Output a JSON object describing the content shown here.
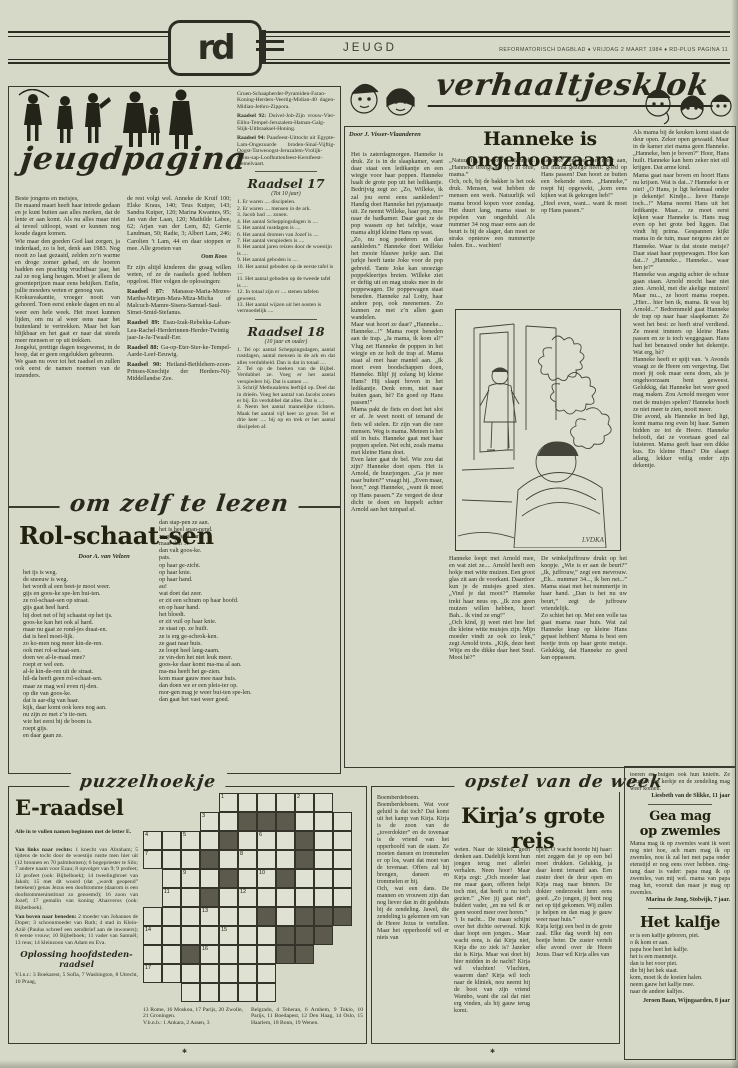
{
  "page": {
    "paper": "#d6d9c8",
    "ink": "#2e2d24"
  },
  "header": {
    "logo": "rd",
    "section": "JEUGD",
    "meta": "REFORMATORISCH DAGBLAD  ♦  VRIJDAG 2 MAART 1984  ♦  RD-PLUS PAGINA 11"
  },
  "jeugd": {
    "script_title": "jeugdpagina",
    "col1": [
      "Beste jongens en meisjes,",
      "De maand maart heeft haar intrede gedaan en je kunt buiten aan alles merken, dat de lente er aan komt. Als nu alles maar niet al teveel uitloopt, want er kunnen nog koude dagen komen.",
      "Wie maar den goeden God laat zorgen, ja inderdaad, zo is het, denk aan 1983. Nog nooit zo laat gezaaid, zelden zo’n warme en droge zomer gehad, en de boeren hadden een prachtig vruchtbaar jaar, het zal ze nog lang heugen. Moet je alleen de groenteprijzen maar eens bekijken. Enfin, jullie moeders weten er genoeg van.",
      "Krokusvakantie, vroeger nooit van gehoord. Toen eerst enkele dagen en nu al weer een hele week. Het moet kunnen lijden, om nu al weer eens naar het buitenland te vertrekken. Maar het kan blijkbaar en het gaat er naar dat steeds meer mensen er op uit trekken.",
      "Jongelui, prettige dagen toegewenst, in de hoop, dat er geen ongelukken gebeuren.",
      "We gaan nu over tot het raadsel en zullen ook eerst de namen noemen van de inzenders."
    ],
    "col2_intro": "de rest volgt wel. Anneke de Kruif 100; Elske Kraus, 140; Teus Kuiper, 143; Sandra Kuiper, 120; Marina Kwantes, 95; Jan van der Laan, 120; Mathilde Labee, 62; Arjan van der Lem, 82; Gerrie Landman, 50; Radie, 3; Albert Lam, 246; Carolien ’t Lam, 44 en daar stoppen er mee. Alle groeten van",
    "col2_sig": "Oom Koos",
    "col2_note": "Er zijn altijd kinderen die graag willen weten, of ze de raadsels goed hebben opgelost. Hier volgen de oplossingen:",
    "col2_answers": [
      {
        "lead": "Raadsel 87:",
        "text": "Manasse-Maria-Mozes-Martha-Mirjam-Mara-Miza-Micha of Malcuch-Mamre-Sisera-Samuel-Saul-Simei-Smid-Stefanus."
      },
      {
        "lead": "Raadsel 89:",
        "text": "Esau-Izak-Rebekka-Laban-Lea-Rachel-Herderinnen-Herder-Twintig jaar-Ja-Ja-Twaalf-Eer."
      },
      {
        "lead": "Raadsel 88:",
        "text": "Ga-op-Eter-Ster-ke-Tempel-Aarde-Leef-Eeuwig."
      },
      {
        "lead": "Raadsel 90:",
        "text": "Heiland-Bethlehem-zoon-Prinses-Knechtje der Herders-Nij-Middellandse Zee."
      }
    ],
    "col3_top": "Gruen-Schaapherder-Pyramiden-Farao-Koning-Herders-Veertig-Midian-40 dagen-Midian-Jethro-Zippora.",
    "col3_answers": [
      {
        "lead": "Raadsel 92:",
        "text": "Duivel-Job-Zijn vrouw-Vier-Elihu-Tempel-Jeruzalem-Haman-Galg-Slijk-Uitbraaksel-Honing."
      },
      {
        "lead": "Raadsel 94:",
        "text": "Paasfeest-Uittocht uit Egypte-Lam-Ongezuurde broden-Sinaï-Vijftig-Oogst-Tarweoogst-Jeruzalem-Vrolijk-Sions-sap-Loofhuttenfeest-Kerstfeest-Hemelvaart."
      }
    ],
    "raadsel17": {
      "title": "Raadsel 17",
      "subtitle": "(Tot 10 jaar)",
      "items": [
        "1. Er waren .... discipelen.",
        "2. Er waren .... mensen in de ark.",
        "3. Jacob had .... zonen.",
        "4. Het aantal Scheppingsdagen is ....",
        "5. Het aantal rustdagen is ....",
        "6. Het aantal dromen van Jozef is ....",
        "7. Het aantal verspieders is ....",
        "8. Het aantal jaren reizen door de woestijn is ....",
        "9. Het aantal geboden is ....",
        "10. Het aantal geboden op de eerste tafel is ....",
        "11. Het aantal geboden op de tweede tafel is ....",
        "12. In totaal zijn er .... stenen tafelen geweest.",
        "13. Het aantal wijzen uit het oosten is vermoedelijk ...."
      ]
    },
    "raadsel18": {
      "title": "Raadsel 18",
      "subtitle": "(10 jaar en ouder)",
      "items": [
        "1. Tel op: aantal Scheppingsdagen, aantal rustdagen, aantal mensen in de ark en dat alles verdubbeld. Dan is dat in totaal ....",
        "2. Tel op de boeken van de Bijbel. Verdubbel ze. Voeg er het aantal verspieders bij. Dat is samen ....",
        "3. Schrijf Methusalems leeftijd op. Deel dat in drieën. Voeg het aantal van Jacobs zonen er bij. En verdubbel dat alles. Dat is ....",
        "4. Neem het aantal mannelijke richters. Maak het aantal vijf keer zo groot. Tel er drie keer .... bij op en trek er het aantal discipelen af."
      ]
    }
  },
  "lezen": {
    "script_title": "om zelf te lezen",
    "headline": "Rol-schaat-sen",
    "byline": "Door A. van Velzen",
    "col1": [
      "het ijs is weg.",
      "de sneeuw is weg.",
      "het wordt al een beet-je mooi weer.",
      "gijs en goos-ke spe-len bui-ten.",
      "ze rol-schaat-sen op straat.",
      "gijs gaat heel hard.",
      "hij doet net of hij schaatst op het ijs.",
      "goos-ke kan het ook al hard.",
      "maar nu gaat ze rond-jes draai-en.",
      "dat is heel moei-lijk.",
      "zo ko-men nog meer kin-de-ren.",
      "ook met rol-schaat-sen.",
      "doen we al-le-maal mee?",
      "roept er wel een.",
      "al-le kin-de-ren uit de straat.",
      "hil-da heeft geen rol-schaat-sen.",
      "maar ze mag wel even rij-den.",
      "op die van goos-ke.",
      "dat is aar-dig van haar.",
      "kijk, daar komt ook kees nog aan.",
      "nu zijn ze met z’n tie-nen.",
      "wie het eerst bij de boom is.",
      "roept gijs.",
      "en daar gaan ze."
    ],
    "col2": [
      "dan stap-pen ze aan.",
      "het is heel span-nend.",
      "ze gaan heel hard.",
      "maar dan ...",
      "dan valt goos-ke.",
      "pats.",
      "op haar ge-zicht.",
      "op haar knie.",
      "op haar hand.",
      "au!",
      "wat doet dat zeer.",
      "er zit een schram op haar hoofd.",
      "en op haar hand.",
      "het bloedt.",
      "er zit vuil op haar knie.",
      "ze staat op. ze huilt.",
      "ze is erg ge-schrok-ken.",
      "ze gaat naar huis.",
      "ze loopt heel lang-zaam.",
      "ze vin-den het niet leuk meer.",
      "goos-ke daar komt ma-ma al aan.",
      "ma-ma heeft het ge-zien.",
      "kom maar gauw mee naar huis.",
      "dan doen we er een pleis-ter op.",
      "mor-gen mag je weer bui-ten spe-len.",
      "dan gaat het vast weer goed."
    ]
  },
  "verhaal": {
    "script_title": "verhaaltjesklok",
    "byline": "Door J. Visser-Vlaanderen",
    "headline": "Hanneke is ongehoorzaam",
    "illustration_signature": "LVDKA",
    "col1": [
      "Het is zaterdagmorgen. Hanneke is druk. Ze is in de slaapkamer, want daar staat een ledikantje en een wiegje voor haar poppen. Hanneke haalt de grote pop uit het ledikantje. Bedrijvig zegt ze: „Zo, Willeke, ik zal jou eerst eens aankleden!” Handig doet Hanneke het pyjamaatje uit. Ze neemt Willeke, haar pop, mee naar de badkamer. Daar gaat ze de pop wassen op het tafeltje, waar mama altijd kleine Hans op wast.",
      "„Zo, nu nog poederen en dan aankleden.” Hanneke doet Willeke het mooie blauwe jurkje aan. Dat jurkje heeft tante Joke voor de pop gebreid. Tante Joke kan snoezige poppekleertjes breien. Willeke ziet er deftig uit en mag straks mee in de poppewagen. De poppewagen staat beneden. Hanneke zal Lotty, haar andere pop, ook meenemen. Zo kunnen ze met z’n allen gaan wandelen.",
      "Maar wat hoort ze daar? „Hanneke... Hanneke...!” Mama roept beneden aan de trap. „Ja mama, ik kom al!” Vlug zet Hanneke de poppen in het wiegje en ze holt de trap af. Mama staat al met haar mantel aan. „Ik moet even boodschappen doen, Hanneke. Blijf jij zolang bij kleine Hans? Hij slaapt boven in het ledikantje. Denk erom, niet naar buiten gaan, hè? En goed op Hans passen!”",
      "Mama pakt de fiets en doet het slot er af. Je weet nooit of iemand de fiets wil stelen. Er zijn van die rare mensen. Weg is mama. Meteen is het stil in huis. Hanneke gaat met haar poppen spelen. Net echt, zoals mama met kleine Hans doet.",
      "Even later gaat de bel. Wie zou dat zijn? Hanneke doet open. Het is Arnold, de buurjongen. „Ga je mee naar buiten?” vraagt hij. „Even maar, hoor,” zegt Hanneke, „want ik moet op Hans passen.” Ze vergeet de deur dicht te doen en huppelt achter Arnold aan het tuinpad af."
    ],
    "col2a": [
      "„Natuurlijk,” belooft Hanneke. „Hanneke brengt het fijn in orde, mama.”",
      "Och, och, bij de bakker is het ook druk. Mensen, wat hebben de mensen een werk. Natuurlijk wil mama brood kopen voor zondag. Het duurt lang, mama staat te popelen van ongeduld. Als nummer 34 nog maar eens aan de beurt is bij de slager, dan moet ze straks opnieuw een nummertje halen. En... wachten!"
    ],
    "col3a": [
      "Hanneke denkt er niet meer aan, dat mama gezegd heeft: goed op Hans passen! Dan hoort ze buiten een bekende stem. „Hanneke,” roept hij opgewekt, „kom eens kijken wat ik gekregen heb!”",
      "„Heel even, want... want ik moet op Hans passen.”"
    ],
    "col2b": [
      "Hanneke loopt met Arnold mee, en wat ziet ze.... Arnold heeft een hokje met witte muizen. Een groot glas zit aan de voorkant. Daardoor kun je de muisjes goed zien. „Vind je dat mooi?” Hanneke trekt haar neus op. „Ik zou geen muizen willen hebben, hoor! Bah... ik vind ze eng!”",
      "„Och kind, jij weet niet hoe lief die kleine witte muisjes zijn. Mijn moeder vindt ze ook zo leuk,” zegt Arnold trots. „Kijk, deze heet Witje en die dikke daar heet Snuf. Mooi hè?”"
    ],
    "col3b": [
      "De winkeljuffrouw drukt op het knopje. „Wie is er aan de beurt?” „Ik, juffrouw,” zegt een mevrouw. „Eh... nummer 34..., ik ben net...” Mama staat met het nummertje in haar hand. „Dan is het nu uw beurt,” zegt de juffrouw vriendelijk.",
      "Zo schiet het op. Met een volle tas gaat mama naar huis. Wat zal Hanneke knap op kleine Hans gepast hebben! Mama is best een beetje trots op haar grote meisje. Gelukkig, dat Hanneke zo goed kan oppassen."
    ],
    "col4": [
      "Als mama bij de keuken komt staat de deur open. Zeker open gewaaid. Maar in de kamer ziet mama geen Hanneke. „Hanneke, ben je boven?” Hoor, Hans huilt. Hanneke kan hem zeker niet stil krijgen. Dat arme kind.",
      "Mama gaat naar boven en hoort Hans nu krijsen. Wat is dat...? Hanneke is er niet! „O Hans, je ligt helemaal onder je dekentje! Kindje... lieve Hansje toch...!” Mama neemt Hans uit het ledikantje. Maar... ze moet eerst kijken waar Hanneke is. Hans mag even op het grote bed liggen. Dat vindt hij prima. Gespannen kijkt mama in de tuin, maar nergens ziet ze Hanneke. Waar is dat stoute meisje? Daar staat haar poppewagen. Hoe kan dat...? „Hanneke... Hanneke... waar ben je?”",
      "Hanneke was angstig achter de schuur gaan staan. Arnold mocht haar niet zien. Arnold, met die akelige muizen! Maar nu..., ze hoort mama roepen. „Hier... hier ben ik, mama. Ik was bij Arnold...” Bedremmeld gaat Hanneke de trap op naar haar slaapkamer. Ze weet het best: ze heeft straf verdiend. Ze moest immers op kleine Hans passen en ze is toch weggegaan. Hans had het benauwd onder het dekentje. Wat erg, hè?",
      "Hanneke heeft er spijt van. ’s Avonds vraagt ze de Heere om vergeving. Dat moet jij ook maar eens doen, als je ongehoorzaam bent geweest. Gelukkig, dat Hanneke het weer goed mag maken. Zou Arnold morgen weer met de muisjes spelen? Hanneke hoeft ze niet meer te zien, nooit meer.",
      "Die avond, als Hanneke in bed ligt, komt mama nog even bij haar. Samen bidden ze tot de Heere. Hanneke belooft, dat ze voortaan goed zal luisteren. Mama geeft haar een dikke kus. En kleine Hans? Die slaapt allang, lekker veilig onder zijn dekentje."
    ]
  },
  "puzzel": {
    "script_title": "puzzelhoekje",
    "headline": "E-raadsel",
    "intro": "Alle in te vullen namen beginnen met de letter E.",
    "across_lead": "Van links naar rechts:",
    "across": "1 knecht van Abraham; 5 tijdens de tocht door de woestijn rustte men hier uit (12 bronnen en 70 palmbomen); 6 hogepriester te Silo; 7 andere naam voor Ezau; 8 opvolger van 9; 9 profeet; 12 profeet (ook: Bijbelboek); 14 tweelingbroer van Jakob; 15 met dit woord (dat „wordt geopend” betekent) genas Jezus een doofstomme (daarom is een doofstommeninstituut zo genoemd); 16 zoon van Jozef; 17 gemalin van koning Ahasveros (ook: Bijbelboek).",
    "down_lead": "Van boven naar beneden:",
    "down": "2 moeder van Johannes de Doper; 3 schoonmoeder van Ruth; 4 stad in Klein-Azië (Paulus schreef een zendbrief aan de inwoners); 8 eerste vrouw; 10 Bijbelboek; 11 vader van Samuël; 13 reus; 14 kleinzoon van Adam en Eva.",
    "oplossing_title": "Oplossing hoofdsteden-raadsel",
    "opl_a": "V.l.n.r.: 3 Boekarest, 5 Sofia, 7 Washington, 8 Utrecht, 10 Praag,",
    "opl_b": "13 Rome, 16 Moskou, 17 Parijs, 20 Zwolle, 21 Groningen.\nV.b.n.b.: 1 Ankara, 2 Assen, 3",
    "opl_c": "Belgrado, 4 Teheran, 6 Arnhem, 9 Tokio, 10 Parijs, 11 Boedapest, 12 Den Haag, 14 Oslo, 15 Haarlem, 18 Bonn, 19 Wenen.",
    "footnote_mark": "✱",
    "grid": {
      "rows": [
        "    ...... ",
        "   ..xxx...",
        "....x...x..",
        "...x....x..",
        " ...x..x...",
        " ..x.......",
        "......x.xxx",
        ".......xxx ",
        "..x....xx  ",
        ".......    ",
        "  .....    "
      ],
      "nums": [
        {
          "r": 0,
          "c": 4,
          "n": 1
        },
        {
          "r": 0,
          "c": 8,
          "n": 2
        },
        {
          "r": 1,
          "c": 3,
          "n": 3
        },
        {
          "r": 2,
          "c": 0,
          "n": 4
        },
        {
          "r": 2,
          "c": 2,
          "n": 5
        },
        {
          "r": 2,
          "c": 6,
          "n": 6
        },
        {
          "r": 3,
          "c": 0,
          "n": 7
        },
        {
          "r": 3,
          "c": 5,
          "n": 8
        },
        {
          "r": 4,
          "c": 2,
          "n": 9
        },
        {
          "r": 4,
          "c": 6,
          "n": 10
        },
        {
          "r": 5,
          "c": 1,
          "n": 11
        },
        {
          "r": 5,
          "c": 5,
          "n": 12
        },
        {
          "r": 6,
          "c": 3,
          "n": 13
        },
        {
          "r": 7,
          "c": 0,
          "n": 14
        },
        {
          "r": 7,
          "c": 4,
          "n": 15
        },
        {
          "r": 8,
          "c": 3,
          "n": 16
        },
        {
          "r": 9,
          "c": 0,
          "n": 17
        }
      ]
    }
  },
  "opstel": {
    "script_title": "opstel van de week",
    "headline": "Kirja’s grote reis",
    "col1": [
      "Boemberdeboem. Boemberdeboem. Wat voor geluid is dat toch? Dat komt uit het kamp van Kirja. Kirja is de zoon van de „toverdokter” en de tovenaar is de vriend van het opperhoofd van de stam. Ze moeten dansen en trommelen er op los, want dat moet van de tovenaar. Offers zal hij brengen, dansen en trommelen er bij.",
      "Och, wat een dans. De mannen en vrouwen zijn dan nog liever dan in dit godshuis bij de zendeling. Jawel, die zendeling is gekomen om van de Heere Jezus te vertellen. Maar het opperhoofd wil er niets van"
    ],
    "col2": [
      "weten. Naar de kliniek, geen denken aan. Dadelijk komt hun jongen terug met allerlei verhalen. Neen hoor! Maar Kirja zegt: „Och moeder laat me maar gaan, offeren helpt toch niet, dat heeft u nu toch gezien.” „Nee jij gaat niet”, buldert vader, „en nu wil ik er geen woord meer over horen.”",
      "’t Is nacht... De maan schijnt over het dichte oerwoud. Kijk daar loopt een jongen... Maar wacht eens, is dat Kirja niet, Kirja die zo ziek is? Jazeker dat is Kirja. Maar wat doet hij hier midden in de nacht? Kirja wil vluchten! Vluchten, waarom dan? Kirja wil toch naar de kliniek, nou neemt hij de boot van zijn vriend Wambo, want die zal dat niet erg vinden, als hij gauw terug komt."
    ],
    "col3": [
      "open. O wacht hoorde hij haar: niet zeggen dat je op een bel moet drukken. Gelukkig, ja daar komt iemand aan. Een zuster doet de deur open en Kirja mag naar binnen. De dokter onderzoekt hem eens goed. „Zo jongen, jij bent nog net op tijd gekomen. Wij zullen je helpen en dan mag je gauw weer naar huis.”",
      "Kirja krijgt een bed in de grote zaal. Elke dag wordt hij een beetje beter. De zuster vertelt elke avond over de Heere Jezus. Daar wil Kirja alles van"
    ]
  },
  "rechts": {
    "kirja_end": "toeren en buigen ook hun knieën. Ze bouwen een kerkje en de zendeling mag weer komen.",
    "sig1": "Liesbeth van de Slikke, 11 jaar",
    "gea_title": "Gea mag\nop zwemles",
    "gea_body": "Mama mag ik op zwemles want ik weet nog niet hoe, ach mam mag ik op zwemles, nou ik zal het met papa onder etenstijd er nog eens over hebben. ring-tang daar is vader: papa mag ik op zwemles, van mij wel. mama van papa mag het, vooruit dan maar je mag op zwemles.",
    "gea_sig": "Marina de Jong, Stolwijk, 7 jaar.",
    "kalfje_title": "Het kalfje",
    "kalfje_lines": [
      "er is een kalfje geboren, piet.",
      "o ik kom er aan.",
      "papa hoe heet het kalfje.",
      "het is een mannetje.",
      "dan is het voor piet.",
      "die bij het hek staat.",
      "kom, moet ik de koeien halen.",
      "neem gauw het kalfje mee.",
      "naar de andere kalfjes."
    ],
    "kalfje_sig": "Jeroen Baan, Wijngaarden, 8 jaar"
  }
}
